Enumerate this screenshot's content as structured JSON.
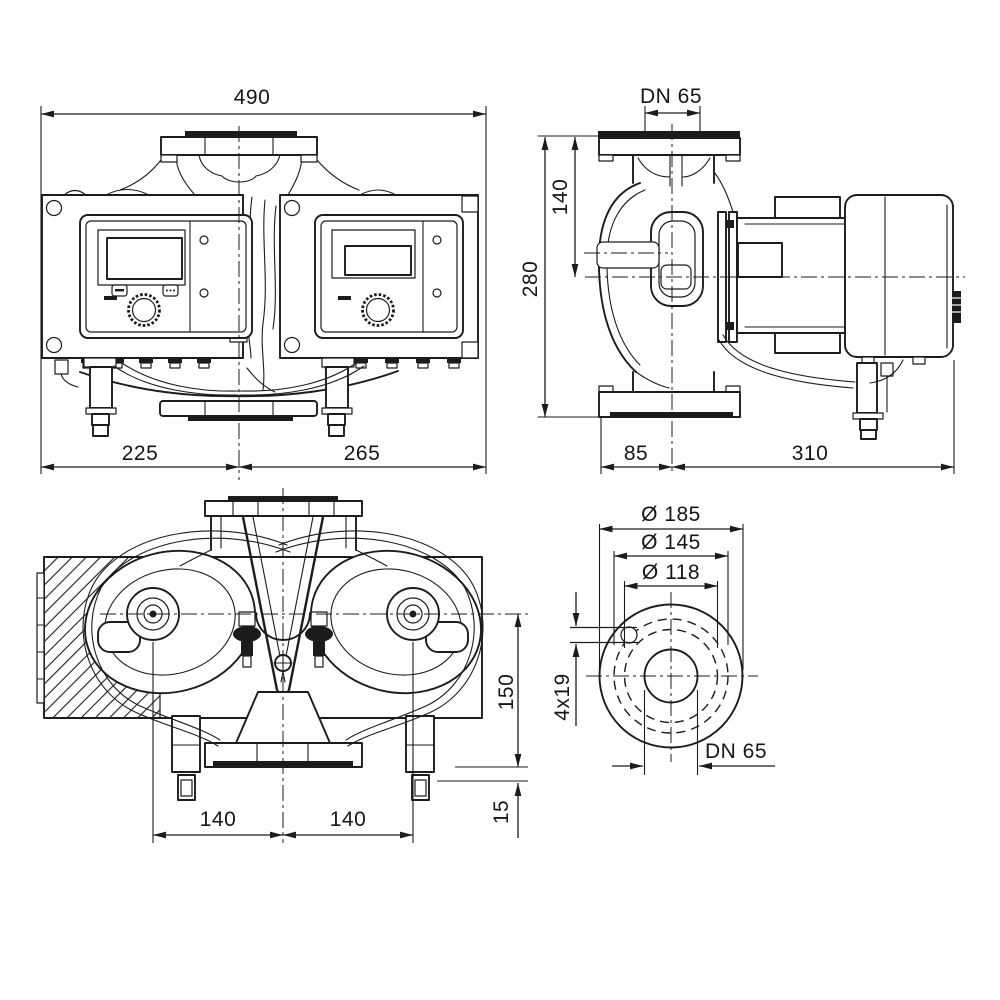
{
  "drawing": {
    "background_color": "#ffffff",
    "line_color": "#1c1c1c",
    "views": {
      "front": {
        "dims": {
          "overall_width": "490",
          "center_to_left": "225",
          "center_to_right": "265"
        }
      },
      "side": {
        "dims": {
          "flange_nominal": "DN 65",
          "flange_to_axis": "140",
          "overall_height": "280",
          "axis_to_flange_edge": "85",
          "axis_to_back": "310"
        }
      },
      "top": {
        "dims": {
          "axis_spacing_left": "140",
          "axis_spacing_right": "140",
          "axis_to_flange_face": "150",
          "flange_to_foot": "15"
        }
      },
      "flange": {
        "dims": {
          "outer_diameter": "Ø 185",
          "bolt_circle_diameter": "Ø 145",
          "raised_face_diameter": "Ø 118",
          "bolt_holes": "4x19",
          "nominal_diameter": "DN 65"
        }
      }
    }
  }
}
